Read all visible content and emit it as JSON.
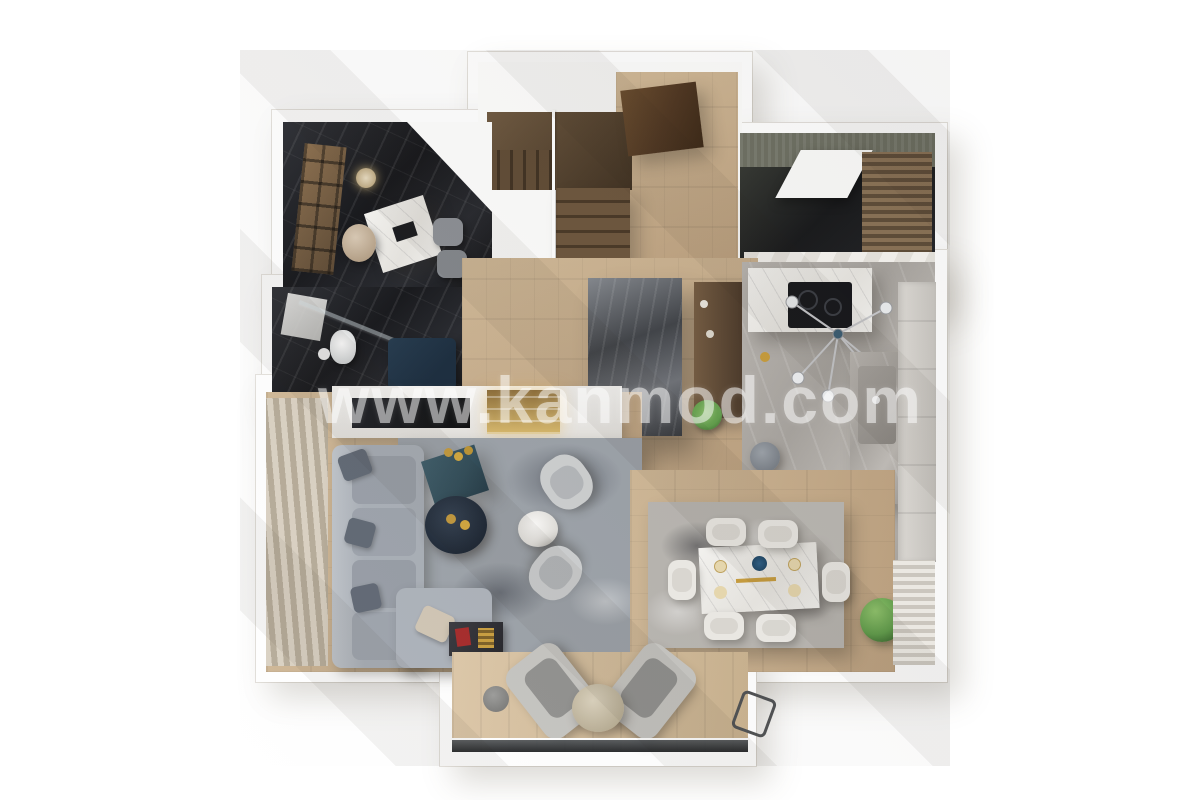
{
  "watermark": {
    "text": "www.kanmod.com"
  },
  "palette": {
    "wall": "#ffffff",
    "wood": "#cfb795",
    "wood_dark": "#bda17f",
    "stair_wood": "#5e4933",
    "door_brown": "#4e3520",
    "marble_dark": "#1b1c20",
    "marble_gray": "#b4b0ab",
    "teal_console": "#2d4a57",
    "sofa": "#a6acb4",
    "rug": "#9aa0a7",
    "gold": "#c79b3a",
    "plant_green": "#5e9c48",
    "navy_tub": "#16283a",
    "red_accent": "#a32424"
  }
}
